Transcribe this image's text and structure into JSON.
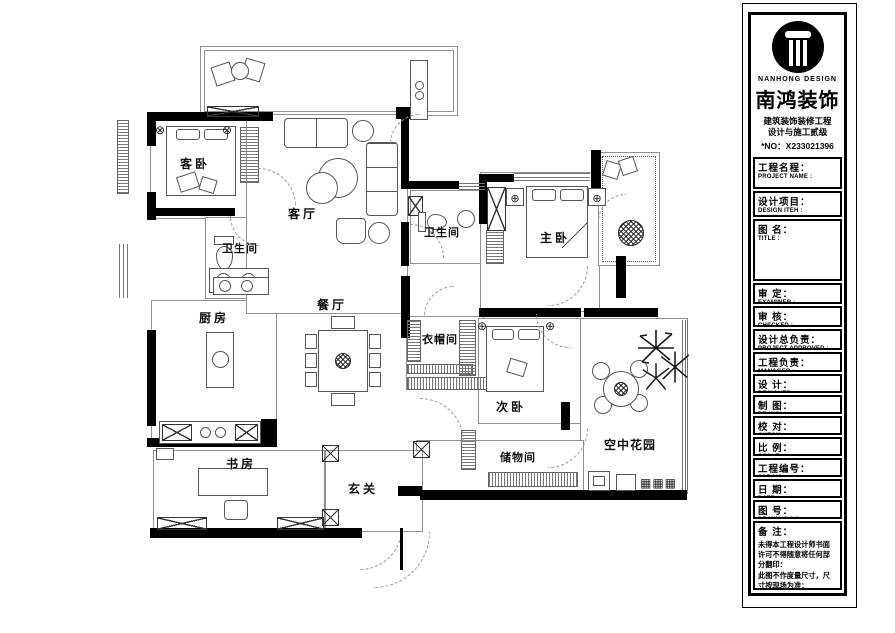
{
  "plan": {
    "rooms": [
      {
        "id": "guest-bedroom",
        "label": "客卧"
      },
      {
        "id": "living-room",
        "label": "客厅"
      },
      {
        "id": "bathroom-1",
        "label": "卫生间"
      },
      {
        "id": "bathroom-2",
        "label": "卫生间"
      },
      {
        "id": "master-bedroom",
        "label": "主卧"
      },
      {
        "id": "kitchen",
        "label": "厨房"
      },
      {
        "id": "dining-room",
        "label": "餐厅"
      },
      {
        "id": "cloakroom",
        "label": "衣帽间"
      },
      {
        "id": "second-bedroom",
        "label": "次卧"
      },
      {
        "id": "study",
        "label": "书房"
      },
      {
        "id": "foyer",
        "label": "玄关"
      },
      {
        "id": "storage-room",
        "label": "储物间"
      },
      {
        "id": "sky-garden",
        "label": "空中花园"
      }
    ]
  },
  "title_block": {
    "logo": {
      "brand_en": "NANHONG DESIGN",
      "brand_cn": "南鸿装饰",
      "cert_line1": "建筑装饰装修工程",
      "cert_line2": "设计与施工贰级",
      "license_no": "*NO：X233021396"
    },
    "fields": [
      {
        "cn": "工程名程：",
        "en": "PROJECT NAME :"
      },
      {
        "cn": "设计项目：",
        "en": "DESIGN ITEH :"
      },
      {
        "cn": "图 名：",
        "en": "TITLE :"
      },
      {
        "cn": "审 定：",
        "en": "EXAMINER :"
      },
      {
        "cn": "审 核：",
        "en": "CHECKED :"
      },
      {
        "cn": "设计总负责：",
        "en": "PROJECT APPROVED :"
      },
      {
        "cn": "工程负责：",
        "en": "MANAGER :"
      },
      {
        "cn": "设 计：",
        "en": "DESIGNER :"
      },
      {
        "cn": "制 图：",
        "en": "DRAWN :"
      },
      {
        "cn": "校 对：",
        "en": "CHECK :"
      },
      {
        "cn": "比 例：",
        "en": "SCALE :"
      },
      {
        "cn": "工程编号：",
        "en": "JOB NO. :"
      },
      {
        "cn": "日 期：",
        "en": "DATE :"
      },
      {
        "cn": "图 号：",
        "en": "DRAWING NO. :"
      }
    ],
    "remarks": {
      "title": "备 注：",
      "line1": "未得本工程设计师书面许可不得随意将任何部分翻印：",
      "line2": "此图不作度量尺寸，尺寸按现场为准：",
      "line3": "若有不明之处，应立即通知设计师。",
      "fine_print": "本设计稿版权归设计师所有",
      "hotline": "免费咨询电话:400 8383 168"
    }
  }
}
